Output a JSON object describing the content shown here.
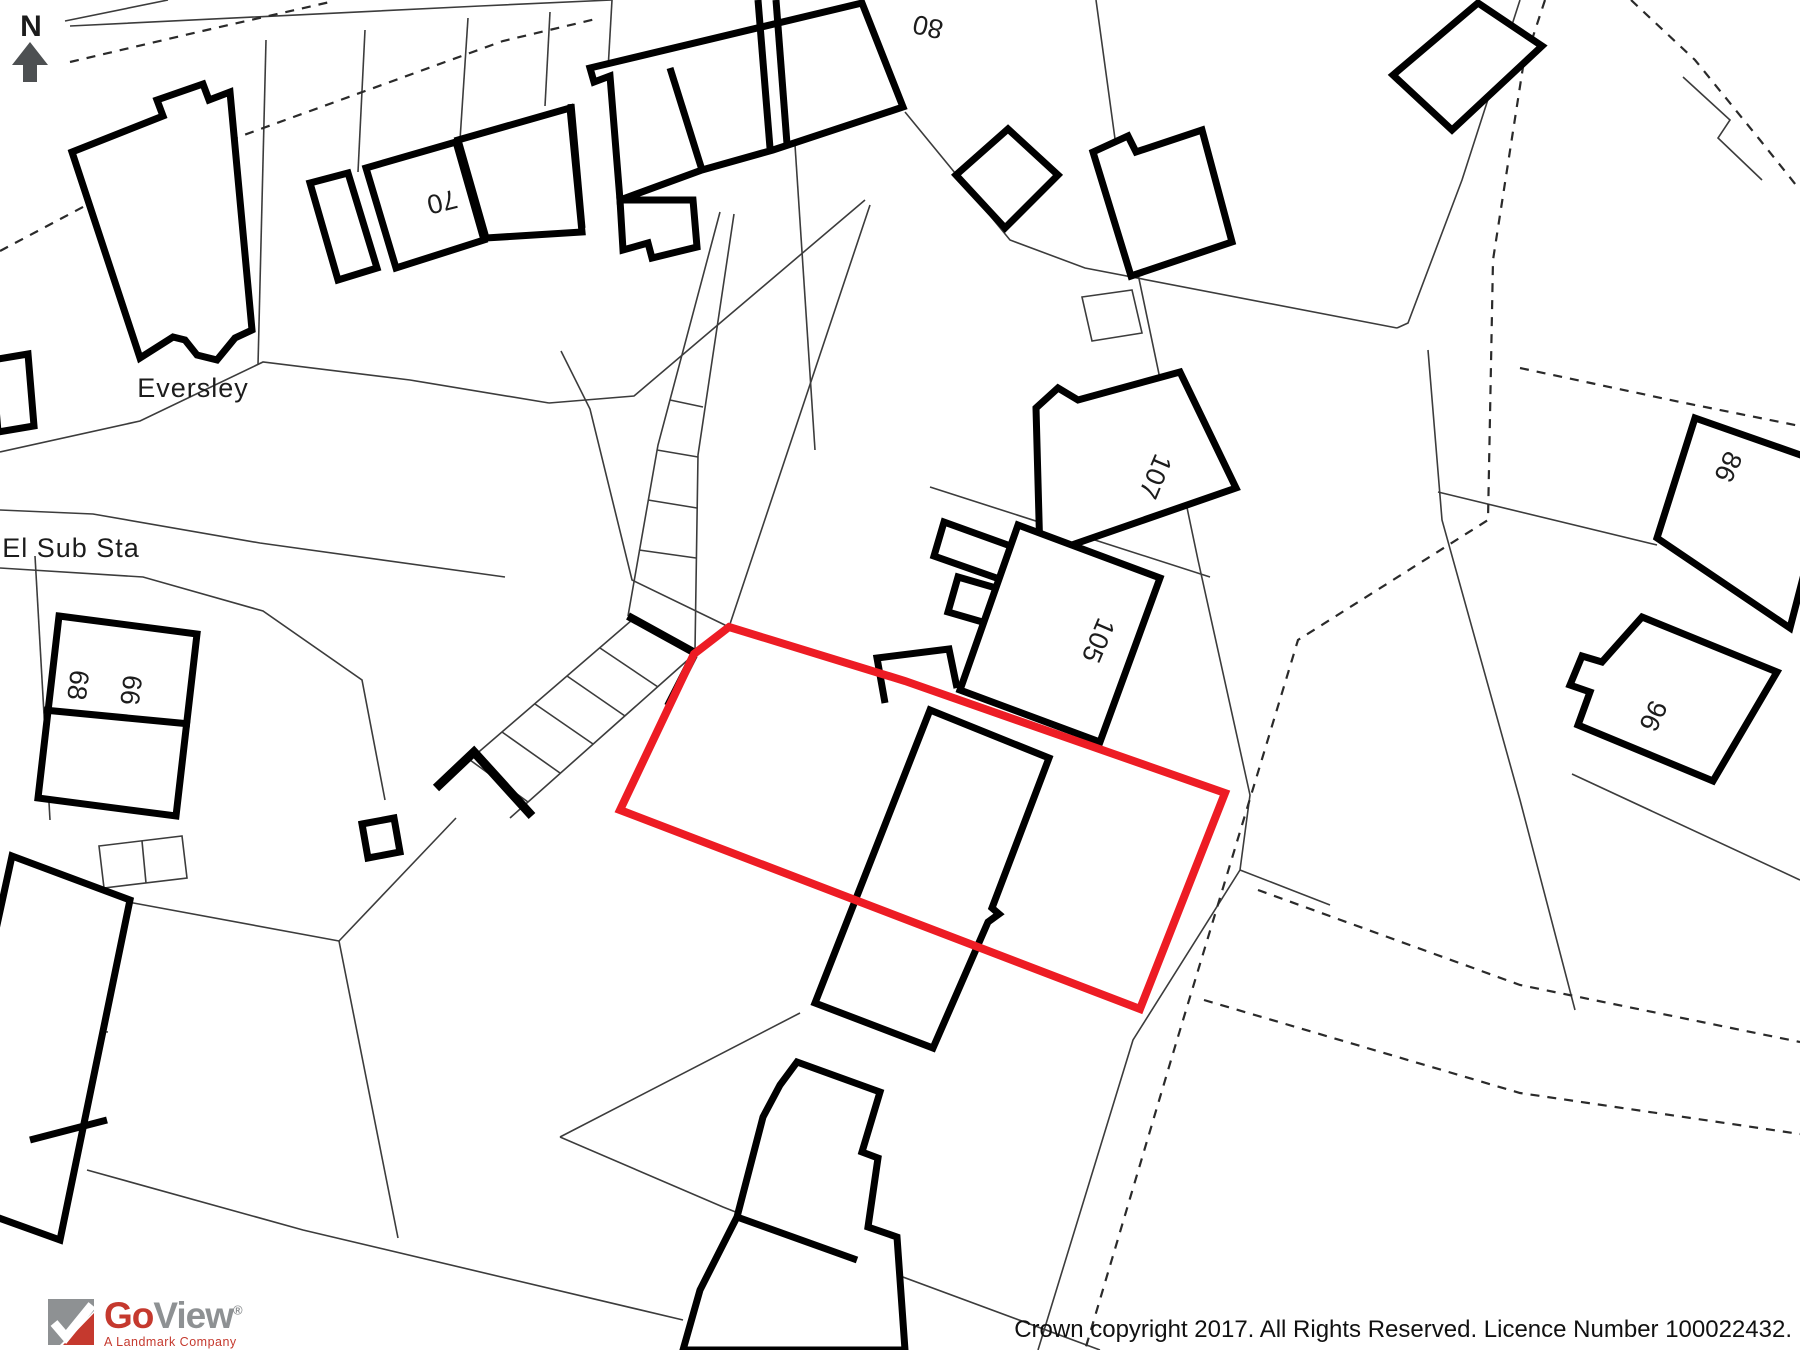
{
  "map": {
    "compass": {
      "label": "N"
    },
    "labels": {
      "eversley": "Eversley",
      "el_sub_sta": "El Sub Sta"
    },
    "house_numbers": {
      "n80": "80",
      "n70": "70",
      "n107": "107",
      "n105": "105",
      "n86": "86",
      "n96": "96",
      "n68": "68",
      "n66": "66"
    },
    "boundary_color": "#ed1c24"
  },
  "footer": {
    "logo": {
      "go": "Go",
      "view": "View",
      "registered": "®",
      "tagline": "A Landmark Company",
      "red": "#c5392e",
      "gray": "#8e9193"
    },
    "copyright": "Crown copyright 2017. All Rights Reserved. Licence Number 100022432."
  }
}
